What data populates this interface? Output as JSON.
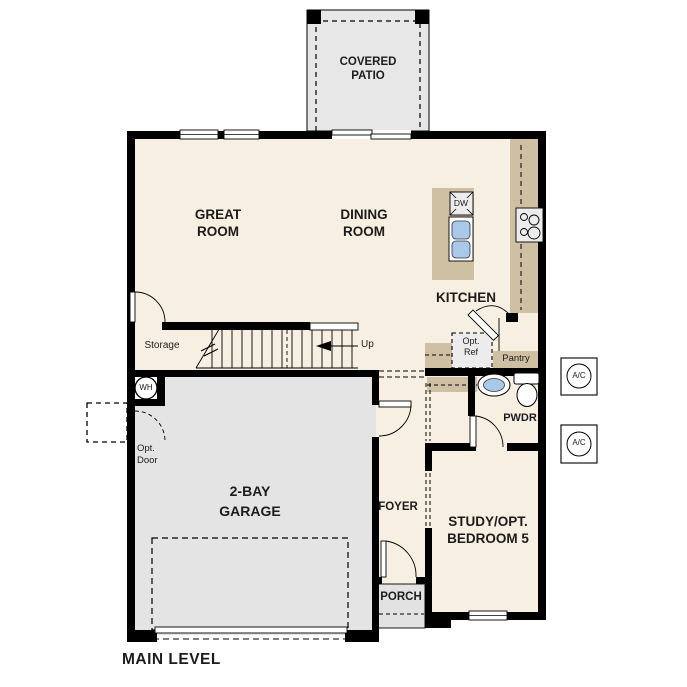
{
  "plan_title": "MAIN LEVEL",
  "rooms": {
    "covered_patio": {
      "line1": "COVERED",
      "line2": "PATIO"
    },
    "great_room": {
      "line1": "GREAT",
      "line2": "ROOM"
    },
    "dining_room": {
      "line1": "DINING",
      "line2": "ROOM"
    },
    "kitchen": {
      "label": "KITCHEN"
    },
    "garage": {
      "line1": "2-BAY",
      "line2": "GARAGE"
    },
    "foyer": {
      "label": "FOYER"
    },
    "porch": {
      "label": "PORCH"
    },
    "study": {
      "line1": "STUDY/OPT.",
      "line2": "BEDROOM 5"
    },
    "powder": {
      "label": "PWDR"
    },
    "pantry": {
      "label": "Pantry"
    },
    "storage": {
      "label": "Storage"
    }
  },
  "annotations": {
    "up_label": "Up",
    "opt_ref_line1": "Opt.",
    "opt_ref_line2": "Ref",
    "opt_door_line1": "Opt.",
    "opt_door_line2": "Door",
    "water_heater": "WH",
    "dishwasher": "DW",
    "ac_unit": "A/C"
  },
  "fixtures": [
    "kitchen-island-sink",
    "dishwasher",
    "cooktop",
    "powder-sink",
    "toilet",
    "water-heater",
    "ac-unit",
    "stairs-up",
    "sliding-door",
    "windows",
    "door-swings"
  ],
  "colors": {
    "floor": "#f7efe1",
    "garage_gray": "#e4e4e4",
    "patio_gray": "#e7e7e7",
    "porch_gray": "#e2e2e2",
    "counter_tan": "#cfc0a4",
    "sink_blue": "#aac8ea",
    "appliance_gray": "#ececec",
    "wall_black": "#000000"
  }
}
